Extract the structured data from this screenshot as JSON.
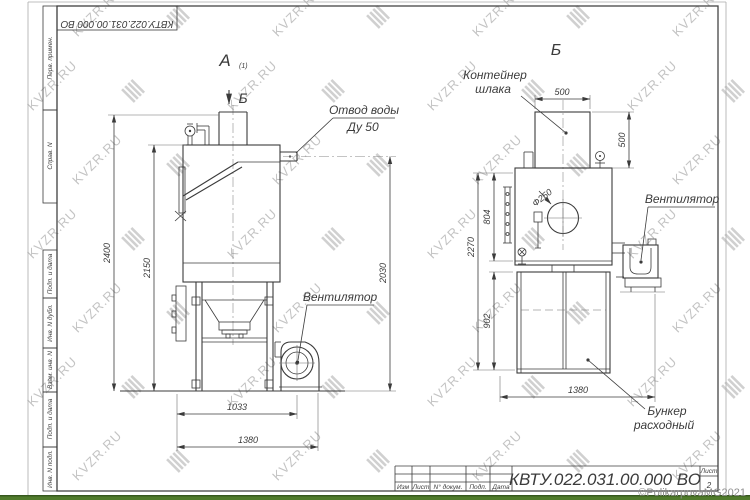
{
  "watermark": {
    "text": "KVZR.RU",
    "copyright": "©PolikarpovaMG2021"
  },
  "stamp": {
    "doc_number": "КВТУ.022.031.00.000 ВО",
    "sheet_label": "Лист",
    "sheet_number": "2",
    "col_izm": "Изм",
    "col_list": "Лист",
    "col_doc": "N° докум.",
    "col_podp": "Подп.",
    "col_data": "Дата"
  },
  "top_stamp": {
    "doc_number": "КВТУ.022.031.00.000  ВО"
  },
  "margin_fields": {
    "f1": "Перв. примен.",
    "f2": "Справ. N",
    "f3": "Подп. и дата",
    "f4": "Инв. N дубл.",
    "f5": "Взам. инв. N",
    "f6": "Подп. и дата",
    "f7": "Инв. N подл."
  },
  "views": {
    "a_label": "А",
    "a_sub": "(1)",
    "b_mark": "Б",
    "b_label": "Б"
  },
  "labels": {
    "water_outlet_1": "Отвод воды",
    "water_outlet_2": "Ду 50",
    "fan_a": "Вентилятор",
    "fan_b": "Вентилятор",
    "slag_1": "Контейнер",
    "slag_2": "шлака",
    "bunker_1": "Бункер",
    "bunker_2": "расходный"
  },
  "dims": {
    "a_total_h": "2400",
    "a_body_h": "2150",
    "a_outlet_h": "2030",
    "a_w1": "1033",
    "a_w2": "1380",
    "b_cont_w": "500",
    "b_cont_h": "500",
    "b_gauge_h": "804",
    "b_total_h": "2270",
    "b_bunker_h": "902",
    "b_depth": "1380",
    "b_hole": "Ф250"
  }
}
